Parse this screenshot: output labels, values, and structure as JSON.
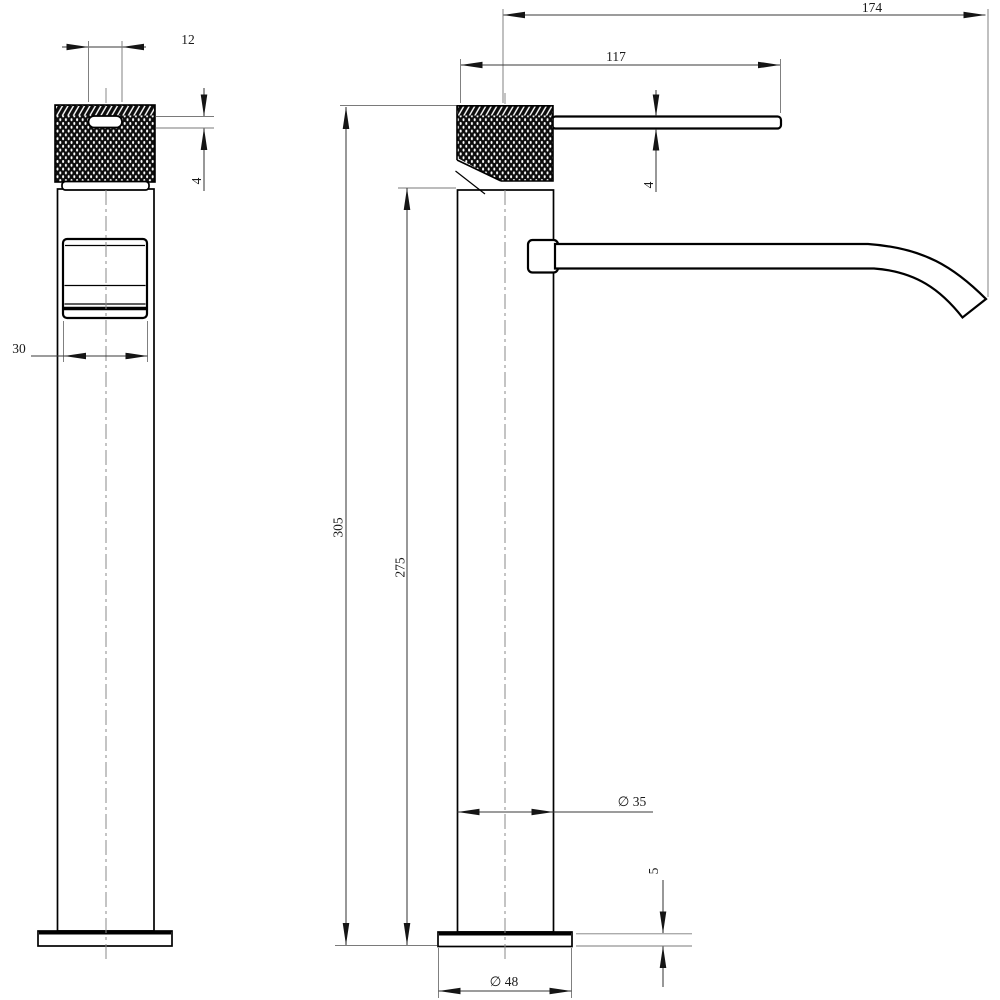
{
  "drawing": {
    "description": "Two-view dimensioned technical drawing of a tall single-lever basin mixer tap",
    "colors": {
      "background": "#ffffff",
      "object_line": "#000000",
      "dimension_line": "#3a3a3a",
      "extension_line": "#7a7a7a"
    },
    "dims": {
      "slot_width": "12",
      "slot_height": "4",
      "spout_block_width": "30",
      "spout_reach": "174",
      "handle_length": "117",
      "handle_thickness": "4",
      "overall_height": "305",
      "body_height": "275",
      "body_diameter": "∅ 35",
      "base_thickness": "5",
      "base_diameter": "∅ 48"
    }
  }
}
